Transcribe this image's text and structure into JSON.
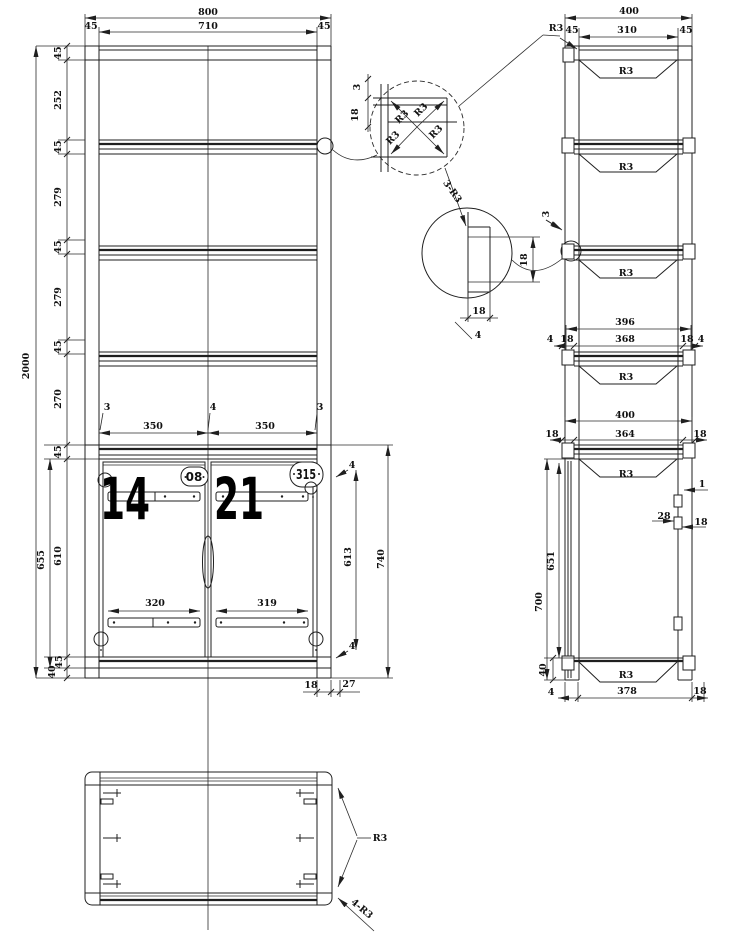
{
  "drawing": {
    "type": "furniture technical drawing",
    "views": [
      "front-view",
      "side-view",
      "plan-view",
      "corner-radius-detail",
      "channel-profile-detail"
    ],
    "ink_color": "#1f1f1f",
    "background": "#ffffff"
  },
  "labels": {
    "front": [
      {
        "t": "800",
        "x": 208,
        "y": 15,
        "n": "front-dim-800"
      },
      {
        "t": "710",
        "x": 208,
        "y": 29,
        "n": "front-dim-710"
      },
      {
        "t": "45",
        "x": 91,
        "y": 29,
        "n": "front-dim-45-left"
      },
      {
        "t": "45",
        "x": 324,
        "y": 29,
        "n": "front-dim-45-right"
      },
      {
        "t": "45",
        "x": 61,
        "y": 53,
        "r": -90,
        "n": "front-chain-45"
      },
      {
        "t": "252",
        "x": 61,
        "y": 100,
        "r": -90,
        "n": "front-chain-252"
      },
      {
        "t": "45",
        "x": 61,
        "y": 147,
        "r": -90,
        "n": "front-chain-45"
      },
      {
        "t": "279",
        "x": 61,
        "y": 197,
        "r": -90,
        "n": "front-chain-279"
      },
      {
        "t": "45",
        "x": 61,
        "y": 247,
        "r": -90,
        "n": "front-chain-45"
      },
      {
        "t": "279",
        "x": 61,
        "y": 297,
        "r": -90,
        "n": "front-chain-279"
      },
      {
        "t": "45",
        "x": 61,
        "y": 347,
        "r": -90,
        "n": "front-chain-45"
      },
      {
        "t": "270",
        "x": 61,
        "y": 399,
        "r": -90,
        "n": "front-chain-270"
      },
      {
        "t": "2000",
        "x": 29,
        "y": 366,
        "r": -90,
        "n": "front-overall-2000"
      },
      {
        "t": "45",
        "x": 61,
        "y": 452,
        "r": -90,
        "n": "front-chain-45"
      },
      {
        "t": "655",
        "x": 44,
        "y": 560,
        "r": -90,
        "n": "front-dim-655"
      },
      {
        "t": "610",
        "x": 61,
        "y": 556,
        "r": -90,
        "n": "front-dim-610"
      },
      {
        "t": "45",
        "x": 62,
        "y": 662,
        "r": -90,
        "n": "front-chain-45"
      },
      {
        "t": "40",
        "x": 55,
        "y": 672,
        "r": -90,
        "n": "front-chain-40"
      },
      {
        "t": "3",
        "x": 107,
        "y": 410,
        "n": "front-dim-3-left"
      },
      {
        "t": "350",
        "x": 153,
        "y": 429,
        "n": "front-dim-350-left"
      },
      {
        "t": "4",
        "x": 213,
        "y": 410,
        "n": "front-dim-4-mid"
      },
      {
        "t": "350",
        "x": 265,
        "y": 429,
        "n": "front-dim-350-right"
      },
      {
        "t": "3",
        "x": 320,
        "y": 410,
        "n": "front-dim-3-right"
      },
      {
        "t": "320",
        "x": 155,
        "y": 606,
        "n": "front-dim-320"
      },
      {
        "t": "319",
        "x": 267,
        "y": 606,
        "n": "front-dim-319"
      },
      {
        "t": "4",
        "x": 352,
        "y": 468,
        "n": "front-dim-4-top"
      },
      {
        "t": "613",
        "x": 351,
        "y": 557,
        "r": -90,
        "n": "front-dim-613"
      },
      {
        "t": "740",
        "x": 384,
        "y": 559,
        "r": -90,
        "n": "front-dim-740"
      },
      {
        "t": "4",
        "x": 352,
        "y": 649,
        "n": "front-dim-4-bottom"
      },
      {
        "t": "18",
        "x": 311,
        "y": 688,
        "n": "front-dim-18"
      },
      {
        "t": "27",
        "x": 349,
        "y": 687,
        "n": "front-dim-27"
      }
    ],
    "doors": [
      {
        "t": "14",
        "x": 125,
        "y": 519,
        "cls": "big",
        "len": 50,
        "anchor": "middle",
        "n": "door-number-14"
      },
      {
        "t": "21",
        "x": 239,
        "y": 519,
        "cls": "big",
        "len": 50,
        "anchor": "middle",
        "n": "door-number-21"
      },
      {
        "t": "08",
        "x": 194,
        "y": 481,
        "cls": "plate",
        "n": "door-plate-08"
      },
      {
        "t": "315",
        "x": 306,
        "y": 479,
        "cls": "plate2",
        "len": 20,
        "n": "door-plate-315"
      }
    ],
    "detail_corner": [
      {
        "t": "3",
        "x": 360,
        "y": 87,
        "r": -90,
        "n": "detail1-dim-3"
      },
      {
        "t": "18",
        "x": 358,
        "y": 115,
        "r": -90,
        "n": "detail1-dim-18"
      },
      {
        "t": "R3",
        "x": 404,
        "y": 119,
        "r": -45,
        "n": "detail1-r3"
      },
      {
        "t": "R3",
        "x": 423,
        "y": 112,
        "r": -45,
        "n": "detail1-r3"
      },
      {
        "t": "R3",
        "x": 395,
        "y": 140,
        "r": -45,
        "n": "detail1-r3"
      },
      {
        "t": "R3",
        "x": 438,
        "y": 134,
        "r": -45,
        "n": "detail1-r3"
      },
      {
        "t": "3-R3",
        "x": 450,
        "y": 193,
        "r": 55,
        "n": "detail2-callout-3-r3"
      }
    ],
    "detail_channel": [
      {
        "t": "18",
        "x": 527,
        "y": 260,
        "r": -90,
        "n": "detail2-dim-18-side"
      },
      {
        "t": "3",
        "x": 549,
        "y": 214,
        "r": -90,
        "n": "detail2-dim-3"
      },
      {
        "t": "18",
        "x": 479,
        "y": 314,
        "n": "detail2-dim-18-bottom"
      },
      {
        "t": "4",
        "x": 478,
        "y": 338,
        "n": "detail2-dim-4"
      }
    ],
    "side": [
      {
        "t": "400",
        "x": 629,
        "y": 14,
        "n": "side-dim-400-top"
      },
      {
        "t": "310",
        "x": 627,
        "y": 33,
        "n": "side-dim-310"
      },
      {
        "t": "45",
        "x": 572,
        "y": 33,
        "n": "side-dim-45-left"
      },
      {
        "t": "45",
        "x": 686,
        "y": 33,
        "n": "side-dim-45-right"
      },
      {
        "t": "R3",
        "x": 556,
        "y": 31,
        "n": "side-r3-top-callout"
      },
      {
        "t": "R3",
        "x": 626,
        "y": 74,
        "n": "side-shelf-r3"
      },
      {
        "t": "R3",
        "x": 626,
        "y": 170,
        "n": "side-shelf-r3"
      },
      {
        "t": "R3",
        "x": 626,
        "y": 276,
        "n": "side-shelf-r3"
      },
      {
        "t": "R3",
        "x": 626,
        "y": 380,
        "n": "side-shelf-r3"
      },
      {
        "t": "R3",
        "x": 626,
        "y": 477,
        "n": "side-shelf-r3"
      },
      {
        "t": "R3",
        "x": 626,
        "y": 678,
        "n": "side-shelf-r3-bottom"
      },
      {
        "t": "396",
        "x": 625,
        "y": 325,
        "n": "side-dim-396"
      },
      {
        "t": "4",
        "x": 550,
        "y": 342,
        "n": "side-dim-4"
      },
      {
        "t": "18",
        "x": 567,
        "y": 342,
        "n": "side-dim-18"
      },
      {
        "t": "368",
        "x": 625,
        "y": 342,
        "n": "side-dim-368"
      },
      {
        "t": "18",
        "x": 687,
        "y": 342,
        "n": "side-dim-18"
      },
      {
        "t": "4",
        "x": 701,
        "y": 342,
        "n": "side-dim-4"
      },
      {
        "t": "400",
        "x": 625,
        "y": 418,
        "n": "side-dim-400-mid"
      },
      {
        "t": "18",
        "x": 552,
        "y": 437,
        "n": "side-dim-18"
      },
      {
        "t": "364",
        "x": 625,
        "y": 437,
        "n": "side-dim-364"
      },
      {
        "t": "18",
        "x": 700,
        "y": 437,
        "n": "side-dim-18"
      },
      {
        "t": "1",
        "x": 702,
        "y": 487,
        "n": "side-dim-1"
      },
      {
        "t": "28",
        "x": 664,
        "y": 519,
        "n": "side-dim-28"
      },
      {
        "t": "18",
        "x": 701,
        "y": 525,
        "n": "side-dim-18-hinge"
      },
      {
        "t": "651",
        "x": 554,
        "y": 561,
        "r": -90,
        "n": "side-dim-651"
      },
      {
        "t": "700",
        "x": 542,
        "y": 602,
        "r": -90,
        "n": "side-dim-700"
      },
      {
        "t": "40",
        "x": 546,
        "y": 670,
        "r": -90,
        "n": "side-dim-40"
      },
      {
        "t": "4",
        "x": 551,
        "y": 695,
        "n": "side-dim-4-bottom"
      },
      {
        "t": "378",
        "x": 627,
        "y": 694,
        "n": "side-dim-378"
      },
      {
        "t": "18",
        "x": 700,
        "y": 694,
        "n": "side-dim-18-bottom"
      }
    ],
    "plan": [
      {
        "t": "R3",
        "x": 380,
        "y": 841,
        "n": "plan-r3-callout"
      },
      {
        "t": "4-R3",
        "x": 360,
        "y": 911,
        "r": 40,
        "n": "plan-4-r3-callout"
      }
    ]
  }
}
